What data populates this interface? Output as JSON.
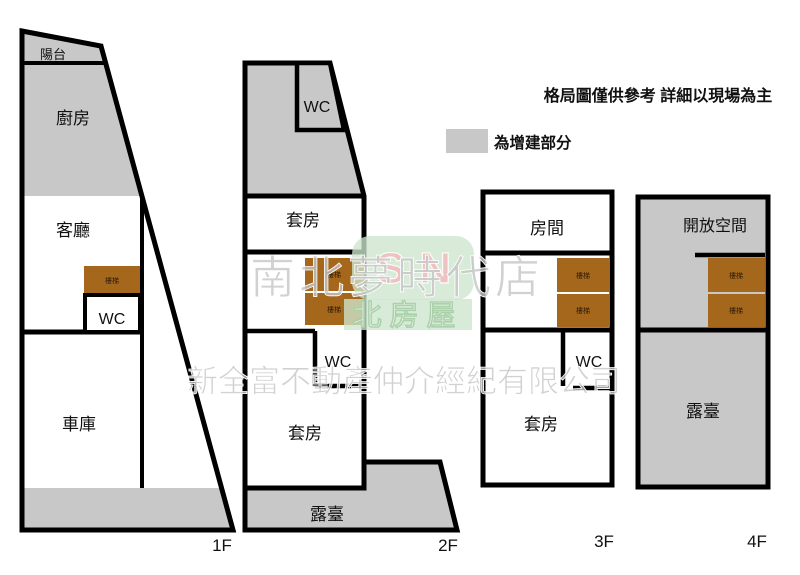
{
  "header": {
    "disclaimer": "格局圖僅供參考 詳細以現場為主"
  },
  "legend": {
    "label": "為增建部分",
    "swatch_color": "#c8c8c8"
  },
  "colors": {
    "addition_gray": "#c8c8c8",
    "wall_black": "#000000",
    "stairs_brown": "#a4671c",
    "logo_green": "#cde6cd",
    "logo_letters_pink": "#f2bcbc",
    "watermark_gray": "#c6c6c6"
  },
  "floors": {
    "f1": {
      "label": "1F",
      "rooms": {
        "balcony": "陽台",
        "kitchen": "廚房",
        "living_room": "客廳",
        "stairs": "樓梯",
        "wc": "WC",
        "garage": "車庫"
      }
    },
    "f2": {
      "label": "2F",
      "rooms": {
        "wc_top": "WC",
        "suite_top": "套房",
        "stairs": "樓梯",
        "wc": "WC",
        "suite": "套房",
        "terrace": "露臺"
      }
    },
    "f3": {
      "label": "3F",
      "rooms": {
        "room": "房間",
        "stairs": "樓梯",
        "wc": "WC",
        "suite": "套房"
      }
    },
    "f4": {
      "label": "4F",
      "rooms": {
        "open_space": "開放空間",
        "stairs": "樓梯",
        "terrace": "露臺"
      }
    }
  },
  "watermark": {
    "logo_letters": "SN",
    "store_name": "南北夢時代店",
    "brand_name": "北房屋",
    "company_name": "新全富不動產仲介經紀有限公司"
  }
}
